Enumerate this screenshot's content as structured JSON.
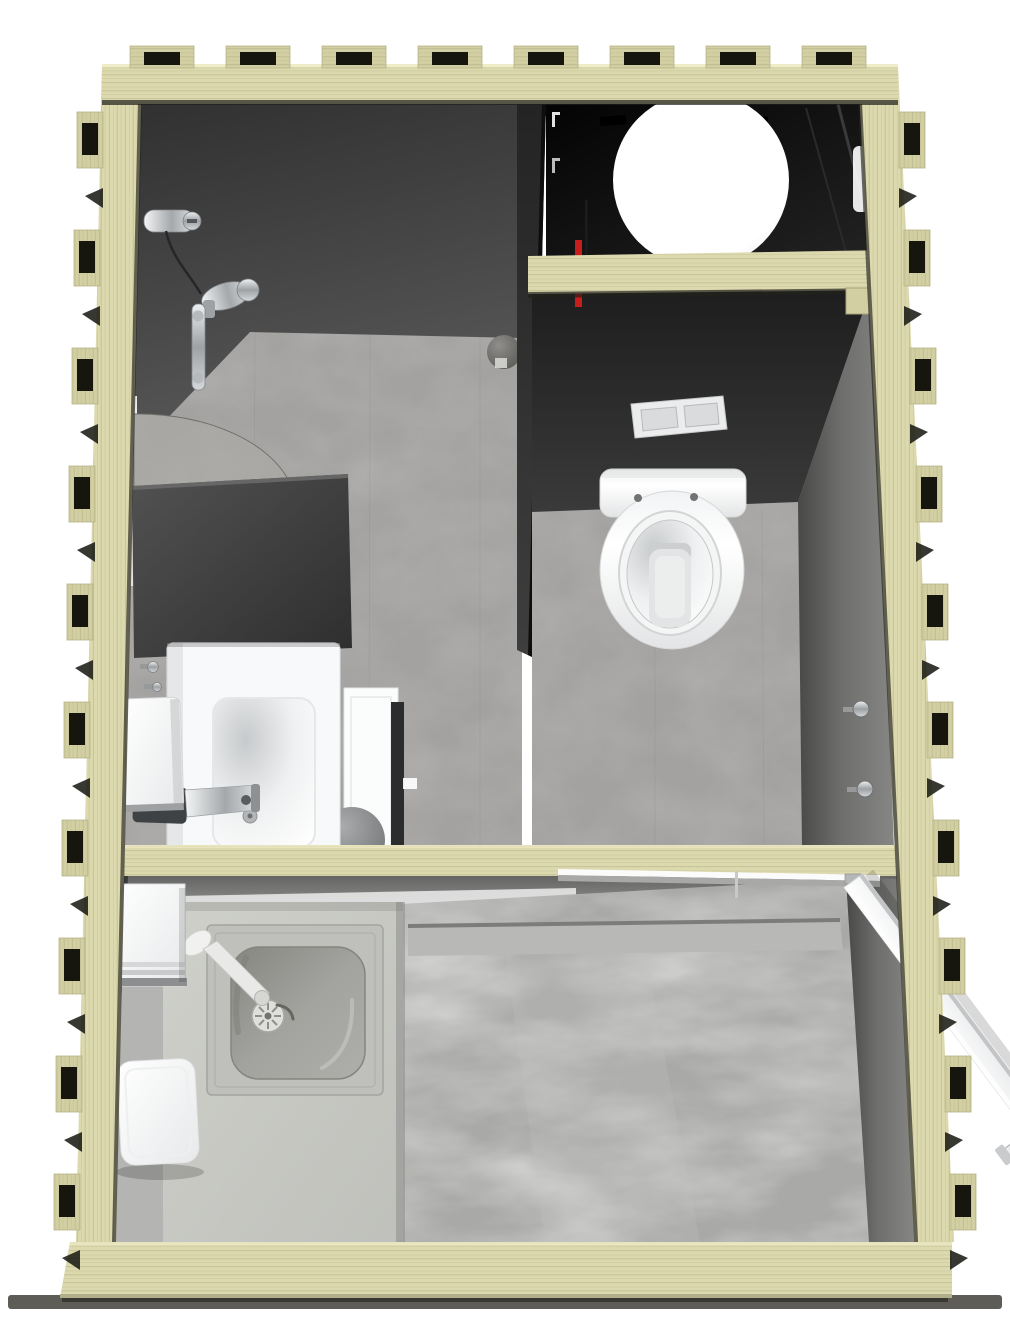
{
  "meta": {
    "title": "Sanitary container module - top-down 3D floor plan rendering",
    "width_px": 1010,
    "height_px": 1326
  },
  "colors": {
    "background": "#ffffff",
    "plywood": "#dcd9ae",
    "plywood_shadowed": "#d2cfa2",
    "wood_grain": "#b3b087",
    "joint_notch": "#16160f",
    "wall_dark": "#3a3a3a",
    "wall_black": "#0a0a0a",
    "wall_light": "#8a8a88",
    "floor_stone": "#a3a2a0",
    "floor_concrete": "#a9a9a7",
    "counter_gray": "#c9cac6",
    "stainless": "#bfc0bc",
    "ceramic_white": "#ffffff",
    "chrome": "#aeb2b5",
    "pipe_red": "#c81d1d",
    "ground_shadow": "#4c4a45"
  },
  "structure": {
    "frame": "interlocking plywood frame with CNC finger-joint tabs on top, left and right edges",
    "beams": [
      "top-frame-beam",
      "tank-shelf-beam",
      "middle-cross-beam",
      "bottom-frame-beam"
    ],
    "view": "orthographic top view with slight perspective, unit wider at bottom"
  },
  "rooms": [
    {
      "id": "shower-room",
      "label": "Shower and washbasin room (upper left)",
      "floor": "grey stone-look vinyl",
      "fixtures": [
        "shower-mixer-valve",
        "shower-hose",
        "hand-shower",
        "shower-rail",
        "floor-drain-dome",
        "corner-shelf",
        "partition-block",
        "washbasin",
        "basin-mixer-tap",
        "soap-dispenser",
        "wall-hooks",
        "interior-door-leaf",
        "round-wall-mirror"
      ]
    },
    {
      "id": "toilet-room",
      "label": "WC room (upper right)",
      "floor": "grey stone-look vinyl",
      "fixtures": [
        "wall-hung-toilet",
        "dual-flush-plate",
        "coat-hook-upper",
        "coat-hook-lower"
      ]
    },
    {
      "id": "technical-compartment",
      "label": "Technical compartment (top right, black)",
      "fixtures": [
        "white-water-tank-sphere",
        "red-supply-pipe",
        "dark-drain-pipe",
        "ceiling-brackets",
        "wall-highlight-panel"
      ]
    },
    {
      "id": "entry-room",
      "label": "Entry / utility room (bottom)",
      "floor": "grey concrete-look",
      "fixtures": [
        "kitchen-sink-unit",
        "sink-drain",
        "sink-tap",
        "counter-block",
        "paper-dispenser-box",
        "toilet-roll-holder-box",
        "entry-door-leaf",
        "door-handle-set",
        "door-mat-strip",
        "glass-screen-edge"
      ]
    }
  ]
}
